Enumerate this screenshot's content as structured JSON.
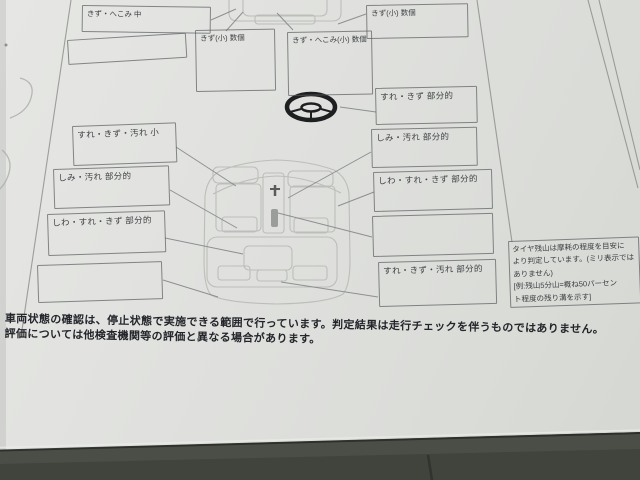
{
  "form": {
    "boxes": {
      "t1": {
        "label": "きず・へこみ 中"
      },
      "t2": {
        "label": ""
      },
      "t3": {
        "label": "きず(小) 数個"
      },
      "t4": {
        "label": "きず・へこみ(小) 数個"
      },
      "t5": {
        "label": "きず(小) 数個"
      },
      "l1": {
        "label": "すれ・きず・汚れ 小"
      },
      "l2": {
        "label": "しみ・汚れ 部分的"
      },
      "l3": {
        "label": "しわ・すれ・きず 部分的"
      },
      "l4": {
        "label": ""
      },
      "r1": {
        "label": "すれ・きず 部分的"
      },
      "r2": {
        "label": "しみ・汚れ 部分的"
      },
      "r3": {
        "label": "しわ・すれ・きず 部分的"
      },
      "r4": {
        "label": ""
      },
      "r5": {
        "label": "すれ・きず・汚れ 部分的"
      }
    },
    "tire_note": {
      "lines": [
        "タイヤ残山は摩耗の程度を目安に",
        "より判定しています。(ミリ表示では",
        "ありません)",
        "[例:残山5分山=概ね50パーセン",
        "ト程度の残り溝を示す]"
      ]
    },
    "footer": {
      "line1": "車両状態の確認は、停止状態で実施できる範囲で行っています。判定結果は走行チェックを伴うものではありません。",
      "line2": "評価については他検査機関等の評価と異なる場合があります。"
    },
    "icons": {
      "steering_wheel": "steering-wheel-icon",
      "gear_shifter": "gear-shifter-icon",
      "car_diagram": "car-interior-top-view"
    },
    "colors": {
      "paper": "#e0e1de",
      "desk": "#4b4e47",
      "form_line": "#8e908c",
      "label_text": "#3e4044",
      "footer_text": "#23252b"
    }
  }
}
